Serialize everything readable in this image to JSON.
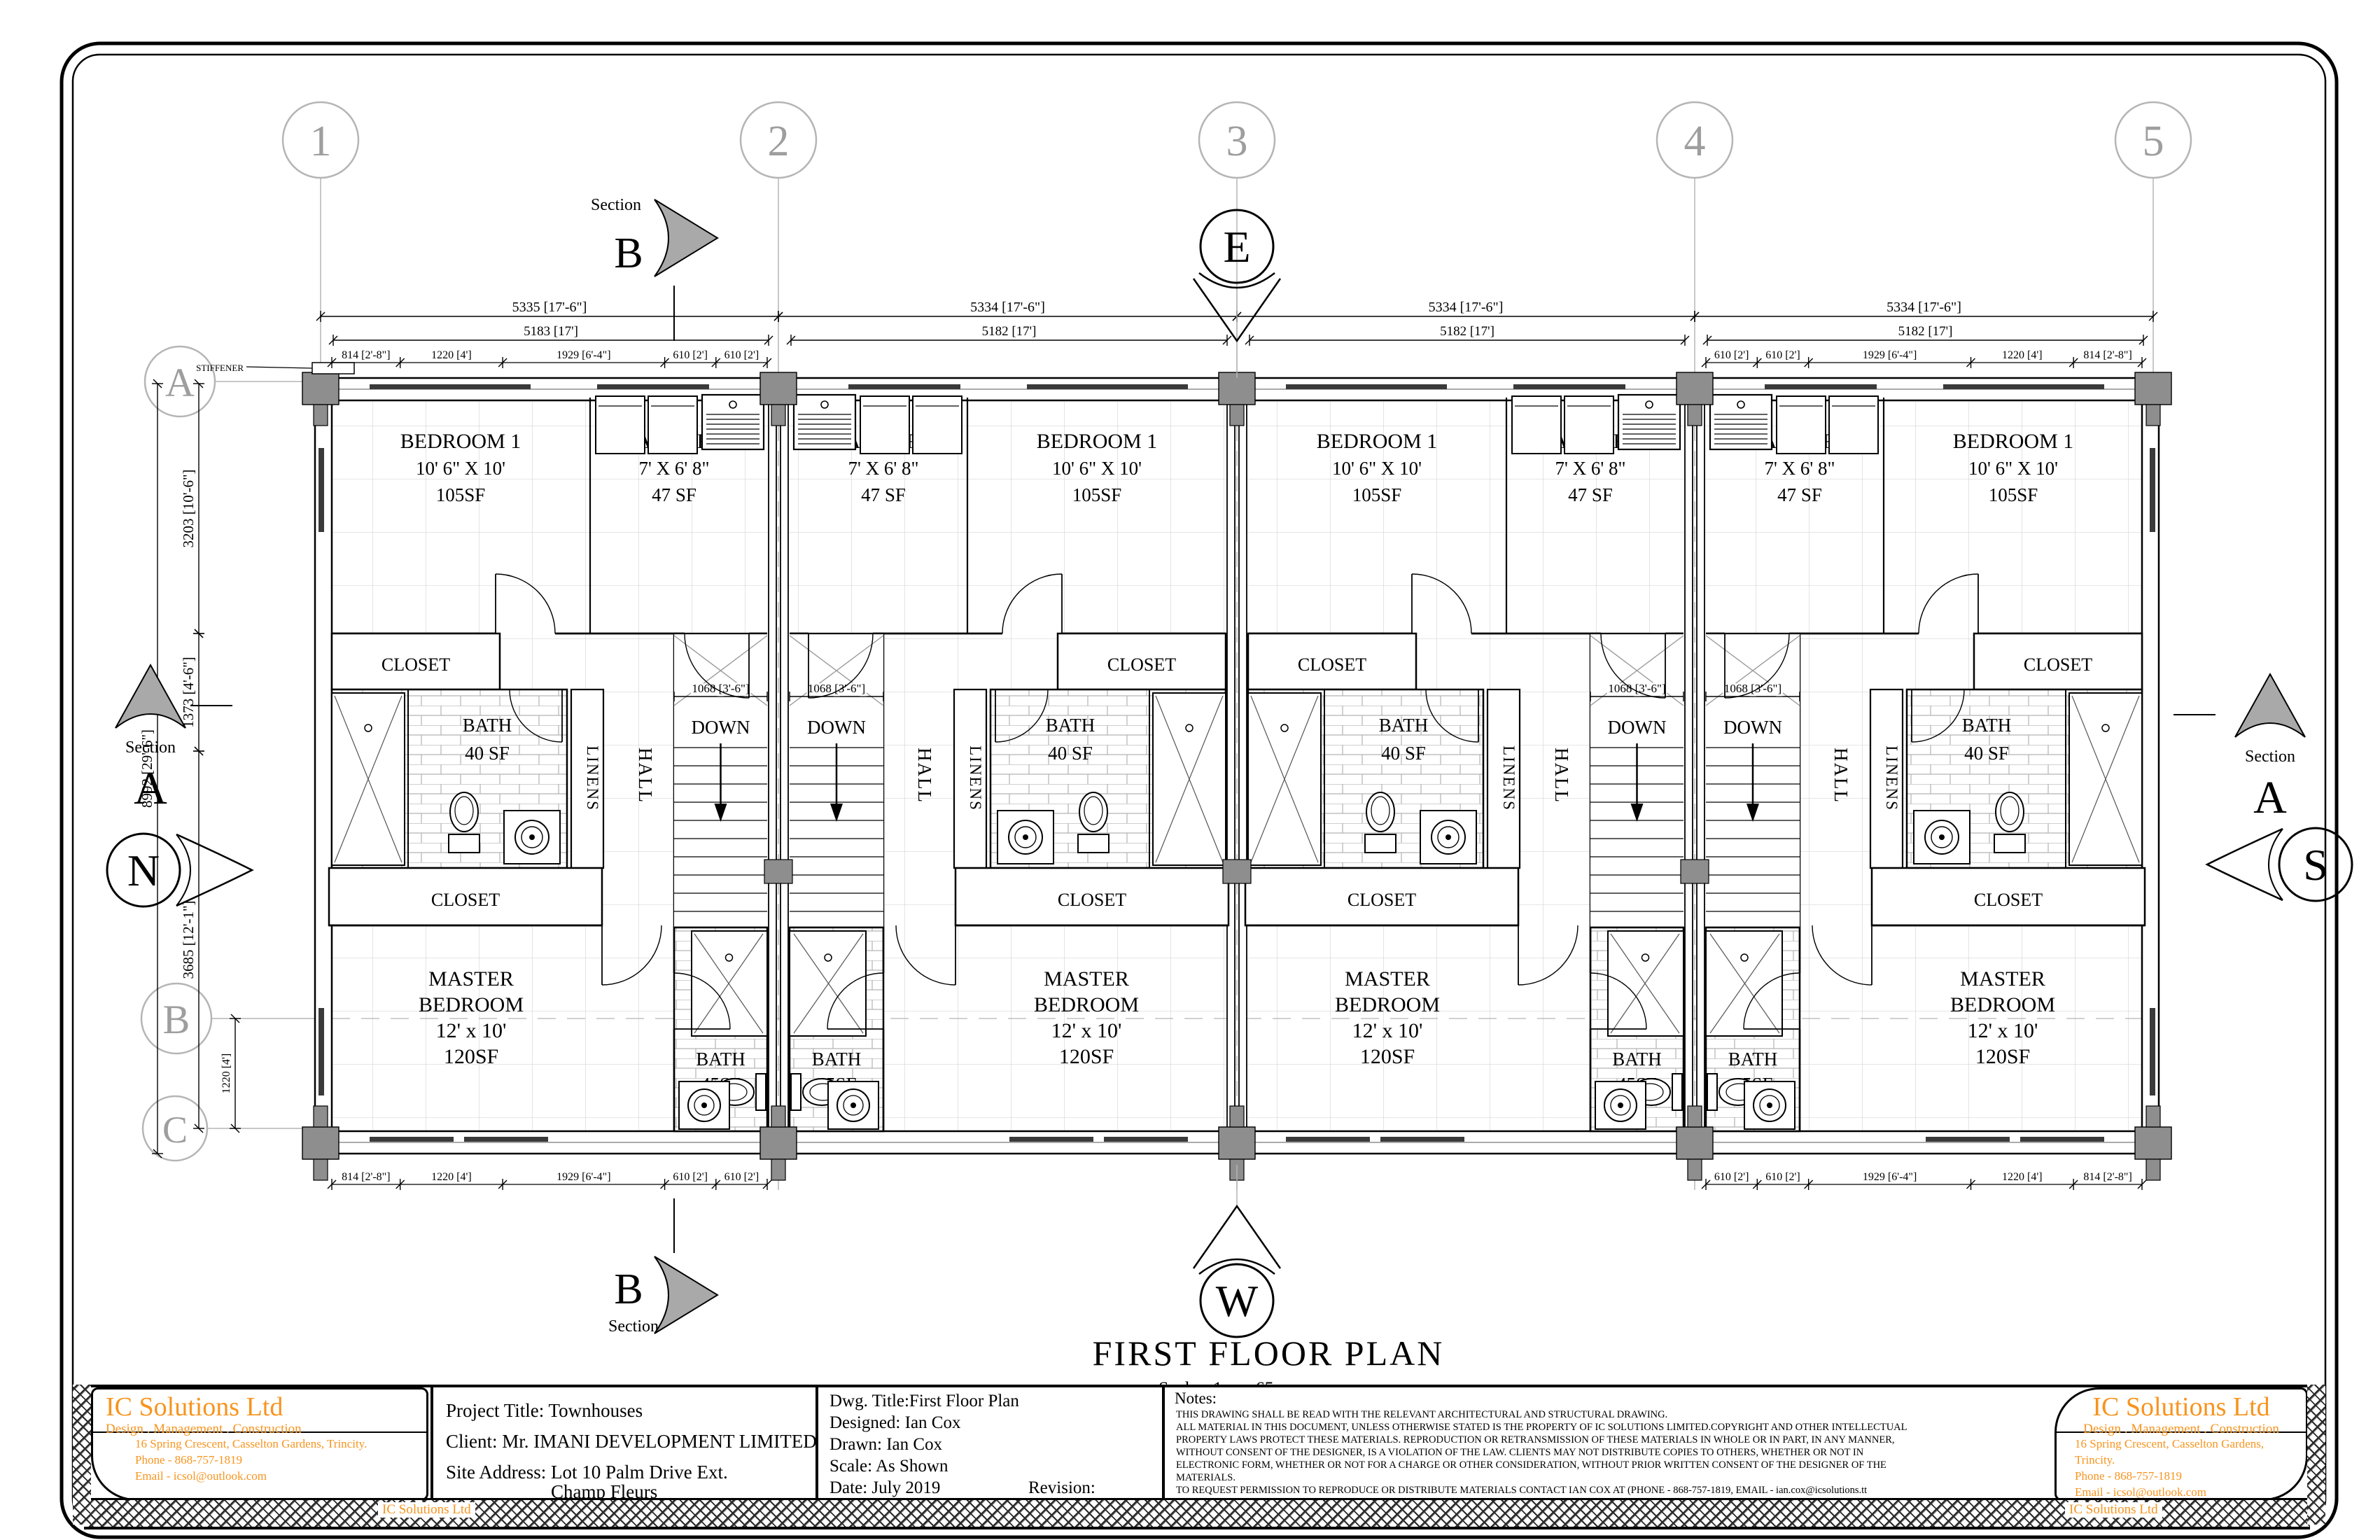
{
  "colors": {
    "ink": "#000000",
    "grid_line": "#b5b5b5",
    "grid_text": "#9e9e9e",
    "column_fill": "#8e8e8e",
    "section_fill": "#a9a9a9",
    "tile": "#d6d6d6",
    "brick": "#b3b3b3",
    "window_dark": "#3a3a3a",
    "accent_orange": "#F7941E"
  },
  "sheet": {
    "plan_title": "FIRST FLOOR PLAN",
    "plan_scale": "Scale - 1mm:65mm",
    "stiffener": "STIFFENER"
  },
  "grid": {
    "top": [
      "1",
      "2",
      "3",
      "4",
      "5"
    ],
    "left": [
      "A",
      "B",
      "C"
    ]
  },
  "compass": {
    "n": "N",
    "s": "S",
    "e": "E",
    "w": "W"
  },
  "sections": {
    "label": "Section",
    "a": "A",
    "b": "B"
  },
  "rooms": {
    "bedroom1": [
      "BEDROOM 1",
      "10' 6\" X 10'",
      "105SF"
    ],
    "laundry": [
      "LAUNDRY",
      "7' X 6' 8\"",
      "47 SF"
    ],
    "closet": "CLOSET",
    "bath40": [
      "BATH",
      "40 SF"
    ],
    "linens": "LINENS",
    "hall": "HALL",
    "down": "DOWN",
    "master": [
      "MASTER",
      "BEDROOM",
      "12' x 10'",
      "120SF"
    ],
    "bath45": [
      "BATH",
      "45SF"
    ]
  },
  "dims": {
    "bay_overall": [
      "5335 [17'-6\"]",
      "5334 [17'-6\"]",
      "5334 [17'-6\"]",
      "5334 [17'-6\"]"
    ],
    "bay_inner": [
      "5183 [17']",
      "5182 [17']",
      "5182 [17']",
      "5182 [17']"
    ],
    "segments": [
      "814 [2'-8\"]",
      "1220 [4']",
      "1929 [6'-4\"]",
      "610 [2']",
      "610 [2']"
    ],
    "segments_mm": [
      814,
      1220,
      1929,
      610,
      610
    ],
    "stair_width": "1068 [3'-6\"]",
    "left_overall": "8992 [29'-6\"]",
    "left_top": "3203 [10'-6\"]",
    "left_mid": "1373 [4'-6\"]",
    "left_bottom": "3685 [12'-1\"]",
    "left_bc": "1220 [4']"
  },
  "title_block": {
    "company": {
      "name": "IC Solutions Ltd",
      "tagline": "Design . Management . Construction",
      "address": "16 Spring Crescent, Casselton Gardens, Trincity.",
      "phone": "Phone - 868-757-1819",
      "email": "Email - icsol@outlook.com",
      "watermark": "IC Solutions Ltd"
    },
    "project": {
      "title": "Project Title: Townhouses",
      "client": "Client: Mr. IMANI DEVELOPMENT LIMITED",
      "site1": "Site Address: Lot 10 Palm Drive Ext.",
      "site2": "Champ Fleurs"
    },
    "drawing": {
      "dwg_title": "Dwg. Title:First Floor Plan",
      "designed": "Designed: Ian Cox",
      "drawn": "Drawn: Ian Cox",
      "scale": "Scale: As Shown",
      "date": "Date: July 2019",
      "revision": "Revision:"
    },
    "notes": {
      "heading": "Notes:",
      "lines": [
        "THIS DRAWING SHALL BE READ WITH THE RELEVANT ARCHITECTURAL AND STRUCTURAL DRAWING.",
        "ALL MATERIAL IN  THIS DOCUMENT, UNLESS OTHERWISE STATED IS THE PROPERTY OF IC SOLUTIONS LIMITED.COPYRIGHT AND OTHER INTELLECTUAL",
        "PROPERTY LAWS PROTECT THESE MATERIALS. REPRODUCTION OR RETRANSMISSION OF THESE MATERIALS IN WHOLE OR IN PART, IN ANY MANNER,",
        "WITHOUT CONSENT OF THE DESIGNER, IS A VIOLATION OF THE LAW. CLIENTS MAY NOT DISTRIBUTE COPIES TO OTHERS, WHETHER OR NOT IN",
        "ELECTRONIC FORM, WHETHER OR NOT FOR A CHARGE OR OTHER CONSIDERATION, WITHOUT PRIOR WRITTEN CONSENT OF THE DESIGNER OF THE",
        "MATERIALS.",
        "TO REQUEST  PERMISSION TO REPRODUCE OR DISTRIBUTE MATERIALS CONTACT IAN COX AT (PHONE - 868-757-1819, EMAIL - ian.cox@icsolutions.tt"
      ]
    }
  }
}
